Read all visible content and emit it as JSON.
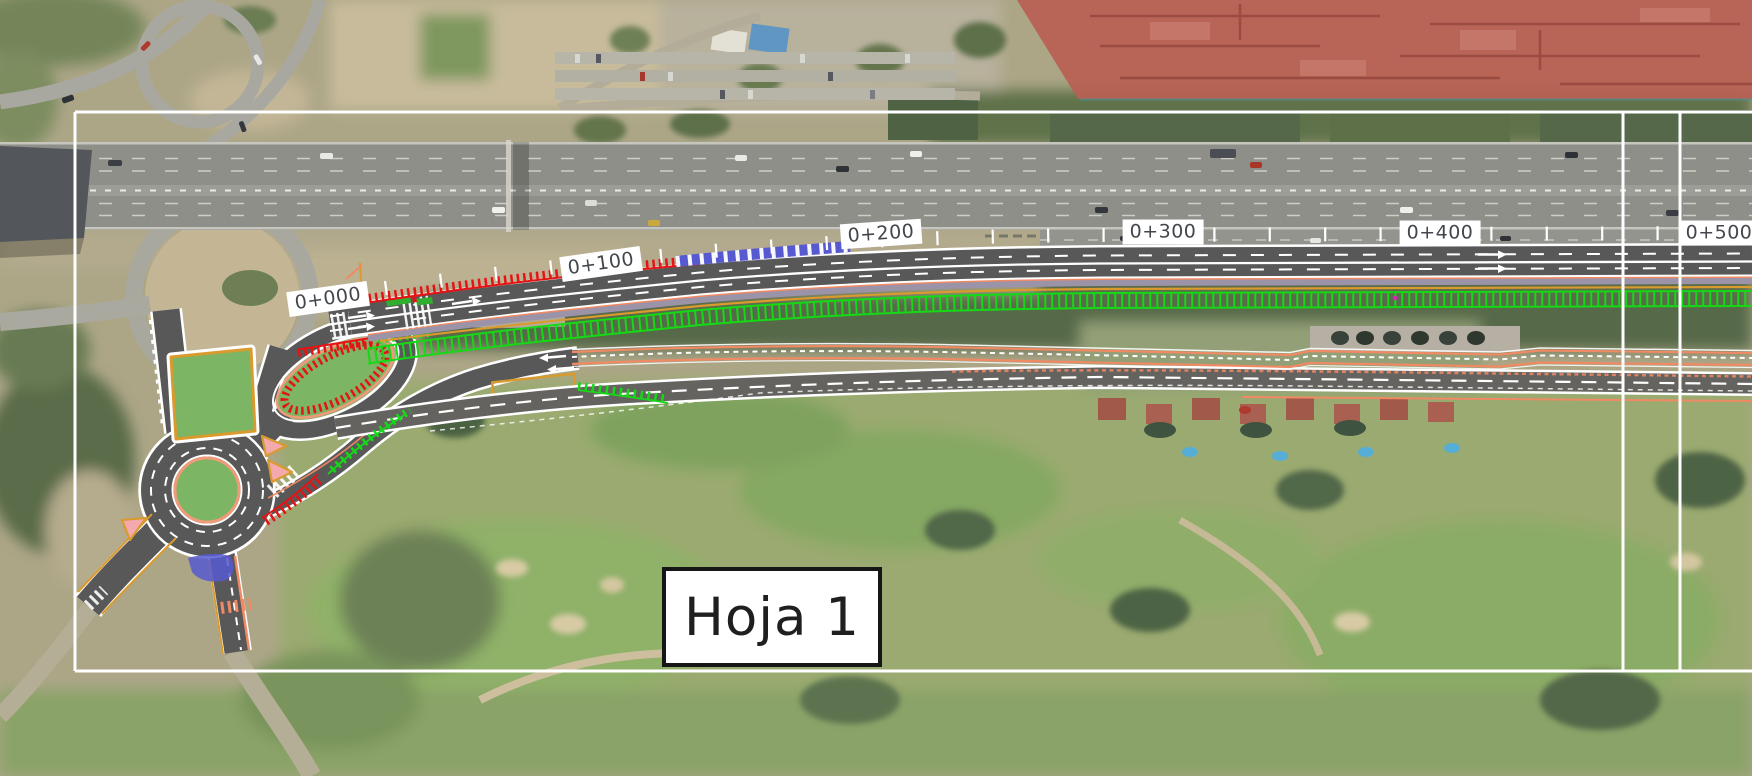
{
  "sheet": {
    "label": "Hoja 1"
  },
  "stations": [
    {
      "label": "0+000"
    },
    {
      "label": "0+100"
    },
    {
      "label": "0+200"
    },
    {
      "label": "0+300"
    },
    {
      "label": "0+400"
    },
    {
      "label": "0+500"
    }
  ],
  "palette": {
    "hatch_red": "#e41414",
    "hatch_green": "#16d916",
    "chevron_blue": "#5659cf",
    "edge_salmon": "#ef8a64",
    "line_orange": "#d99a2e",
    "island_green": "#7cb563",
    "island_pink": "#f3a9ae",
    "pavement_gray": "#585858",
    "median_lavender": "#9b93a8",
    "building_overlay_red": "#b95f52",
    "frame_white": "#ffffff"
  }
}
